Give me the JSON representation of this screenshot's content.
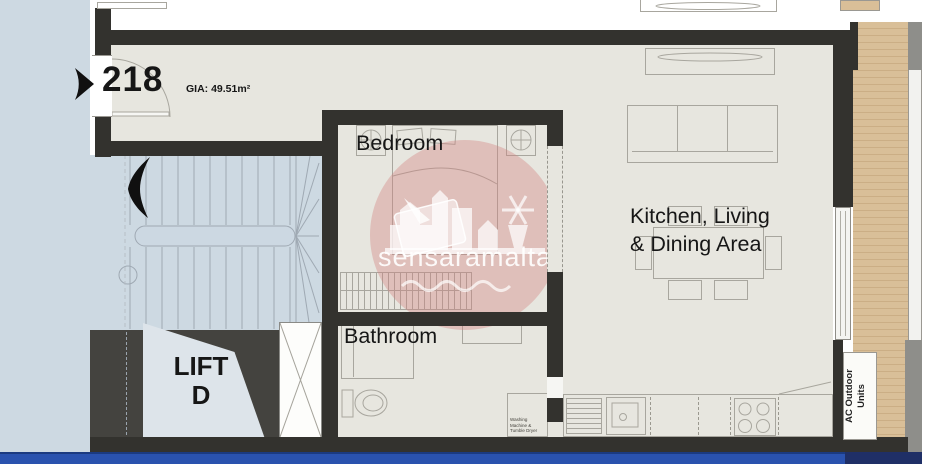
{
  "unit": {
    "number": "218",
    "gia_label": "GIA: 49.51m²"
  },
  "rooms": {
    "bedroom": "Bedroom",
    "kitchen_living_line1": "Kitchen, Living",
    "kitchen_living_line2": "& Dining Area",
    "bathroom": "Bathroom",
    "lift_line1": "LIFT",
    "lift_line2": "D"
  },
  "labels": {
    "ac_outdoor_line1": "AC Outdoor",
    "ac_outdoor_line2": "Units",
    "washing_line1": "Washing",
    "washing_line2": "Machine &",
    "washing_line3": "Tumble Dryer"
  },
  "watermark": {
    "text": "sensaramalta"
  },
  "colors": {
    "wall": "#33322e",
    "floor_cream": "#e7e6df",
    "landing_blue": "#cdd9e2",
    "lift_car_blue": "#dde4ea",
    "lobby_gray": "#44433f",
    "terrace_tan": "#d9bf98",
    "bottom_strip_blue": "#2a52ae",
    "watermark_pink": "#d29681"
  }
}
